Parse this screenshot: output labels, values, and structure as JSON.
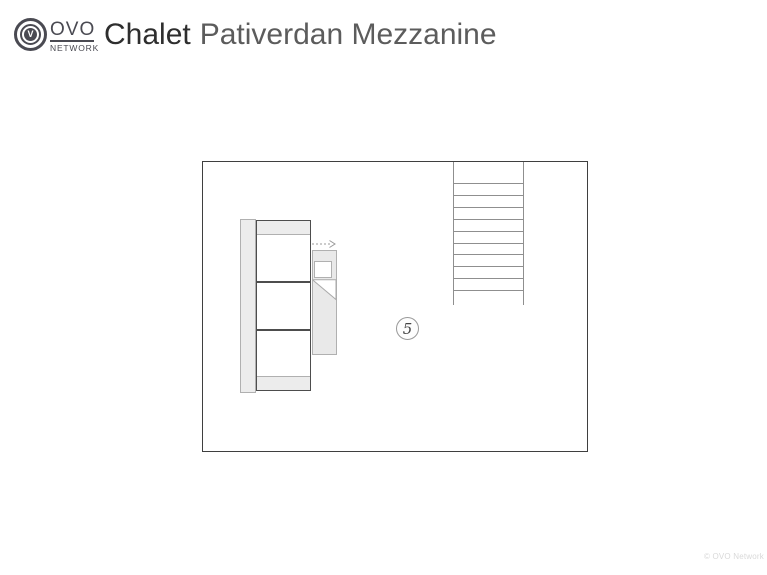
{
  "brand": {
    "emblem_letter": "V",
    "wordmark": "OVO",
    "wordmark_sub": "NETWORK"
  },
  "header": {
    "title_prefix": "Chalet",
    "title_rest": "Pativerdan Mezzanine"
  },
  "floor_plan": {
    "room_number": "5",
    "stairs": {
      "step_count": 10,
      "first_step_offset_px": 21,
      "step_spacing_px": 11.9
    }
  },
  "footer": {
    "copyright": "© OVO Network"
  },
  "colors": {
    "brand_dark": "#4a4a52",
    "title_primary": "#2e2e2e",
    "title_secondary": "#5c5c5c",
    "wall_line": "#3f3f3f",
    "furniture_line": "#4d4d4d",
    "light_line": "#b0b0b0",
    "stair_line": "#8f8f8f",
    "fill_gray": "#ececec",
    "watermark": "#d9d9d9"
  }
}
